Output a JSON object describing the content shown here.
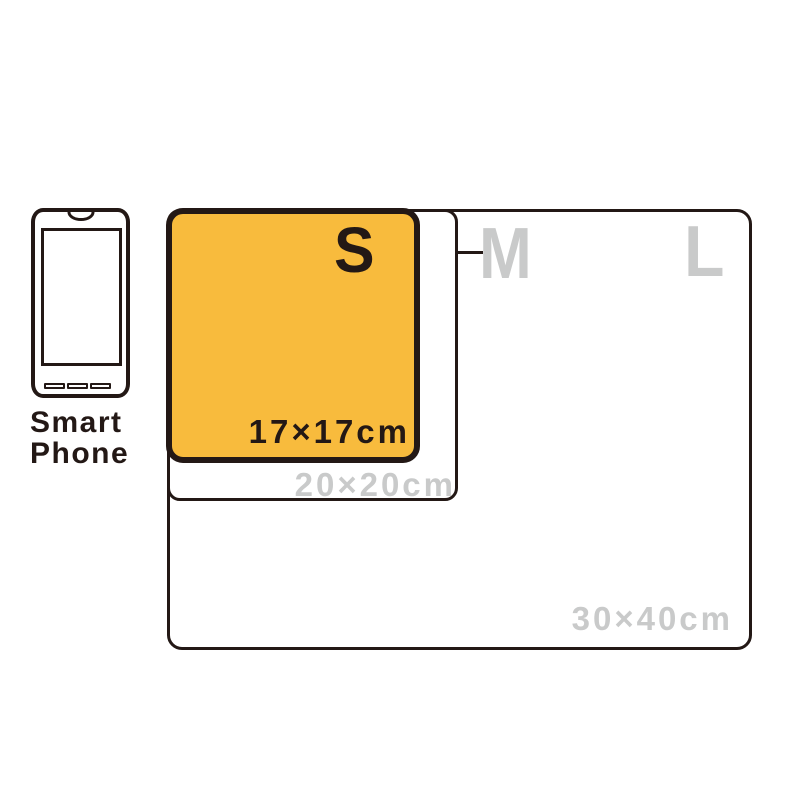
{
  "phone": {
    "label_line1": "Smart",
    "label_line2": "Phone"
  },
  "sizes": {
    "s": {
      "letter": "S",
      "dimensions": "17×17cm",
      "highlighted": true
    },
    "m": {
      "letter": "M",
      "dimensions": "20×20cm",
      "highlighted": false
    },
    "l": {
      "letter": "L",
      "dimensions": "30×40cm",
      "highlighted": false
    }
  },
  "colors": {
    "highlight_fill": "#F8BB3D",
    "outline_dark": "#231815",
    "muted_gray": "#C9CACA",
    "background": "#FFFFFF"
  }
}
